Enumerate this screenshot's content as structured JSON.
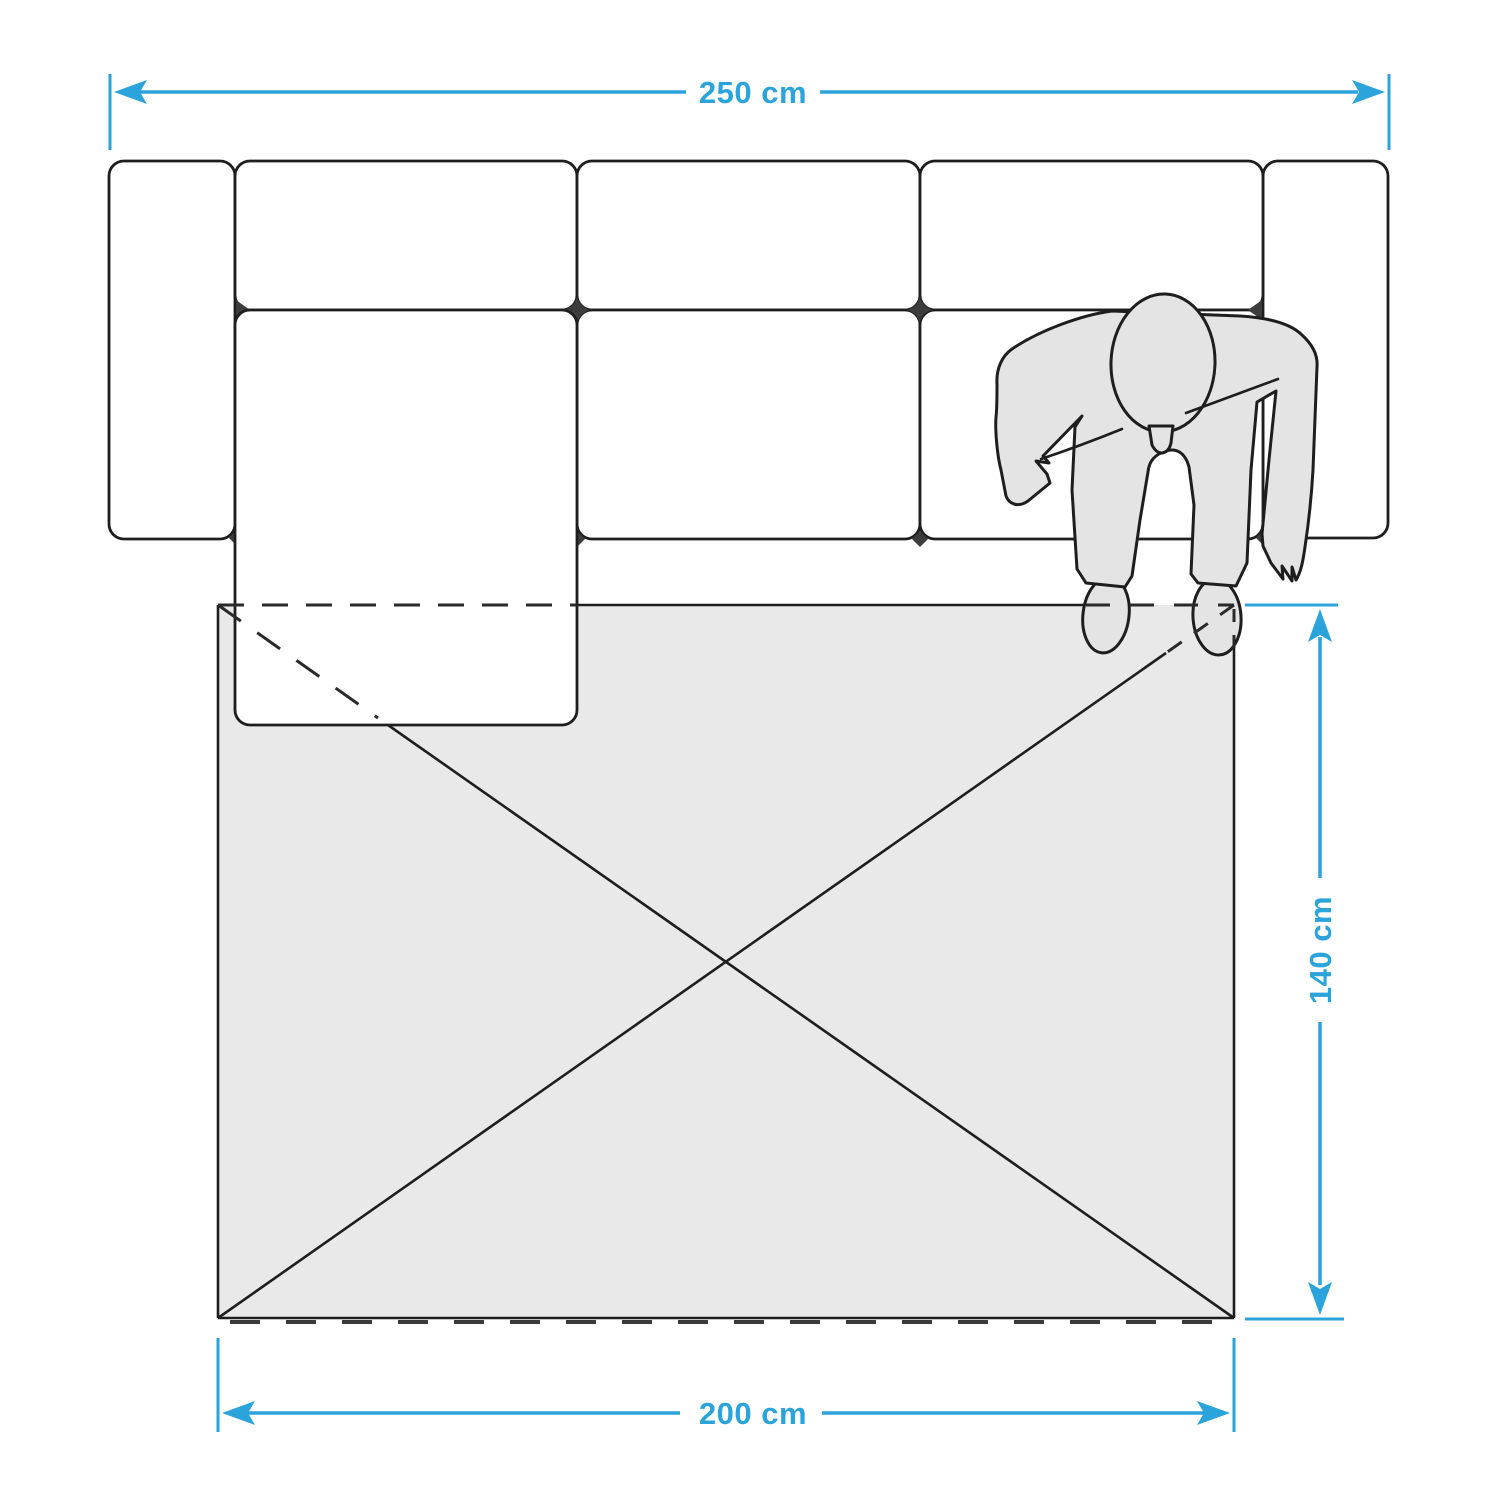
{
  "diagram": {
    "title": "sofa-rug-size-guide",
    "labels": {
      "sofa_width": "250 cm",
      "rug_width": "200 cm",
      "rug_depth": "140 cm"
    },
    "colors": {
      "accent": "#2BA3DB",
      "outline": "#1E1E1E",
      "rug_fill": "#E9E9E9",
      "person_fill": "#E4E4E4",
      "junction": "#3C3C3C",
      "background": "#FFFFFF"
    },
    "icons": [
      "sofa-top-view-icon",
      "chaise-lounge-icon",
      "rug-icon",
      "person-top-view-icon",
      "dimension-arrow-icon"
    ]
  }
}
